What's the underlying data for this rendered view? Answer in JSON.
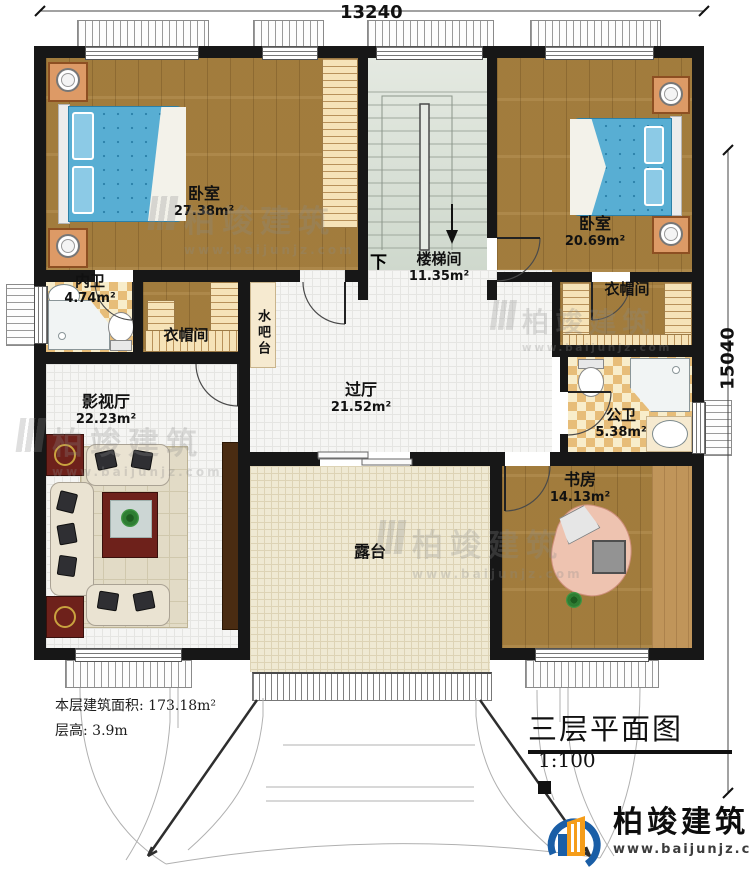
{
  "title": {
    "text": "三层平面图",
    "scale": "1:100"
  },
  "dimensions": {
    "top": "13240",
    "right": "15040"
  },
  "rooms": {
    "bedroom_left": {
      "name": "卧室",
      "area": "27.38m²"
    },
    "inner_bathroom": {
      "name": "内卫",
      "area": "4.74m²"
    },
    "cloakroom_left": {
      "name": "衣帽间"
    },
    "water_bar": {
      "name": "水吧台"
    },
    "stairwell": {
      "name": "楼梯间",
      "area": "11.35m²",
      "down_label": "下"
    },
    "bedroom_right": {
      "name": "卧室",
      "area": "20.69m²"
    },
    "cloakroom_right": {
      "name": "衣帽间"
    },
    "media_room": {
      "name": "影视厅",
      "area": "22.23m²"
    },
    "hall": {
      "name": "过厅",
      "area": "21.52m²"
    },
    "public_bathroom": {
      "name": "公卫",
      "area": "5.38m²"
    },
    "study": {
      "name": "书房",
      "area": "14.13m²"
    },
    "terrace": {
      "name": "露台"
    }
  },
  "footer": {
    "line1": "本层建筑面积: 173.18m²",
    "line2": "层高: 3.9m"
  },
  "logo": {
    "name": "柏竣建筑",
    "url": "www.baijunjz.com"
  },
  "watermark": {
    "text": "柏竣建筑",
    "url": "www.baijunjz.com"
  },
  "colors": {
    "wall": "#171717",
    "wood_floor": "#a8813f",
    "tile_floor": "#f5f5f3",
    "terrace_floor": "#efe9d3",
    "stair_floor": "#dde3d8",
    "checker_tan": "#e7bd79",
    "bed_blue": "#58aed3",
    "logo_blue": "#1a5ea6",
    "logo_orange": "#f59d1a"
  }
}
